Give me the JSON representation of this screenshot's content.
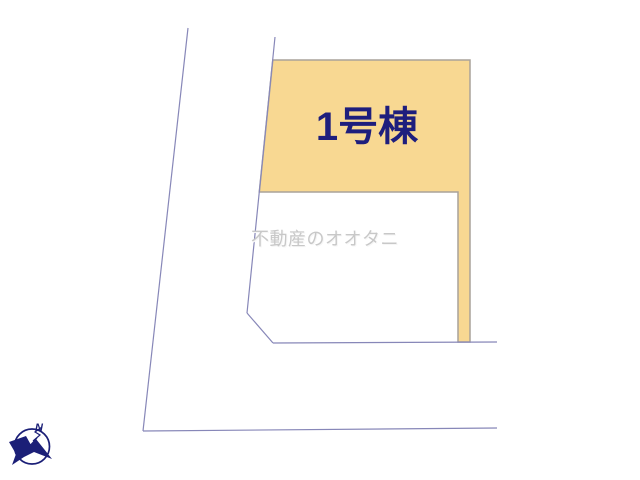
{
  "colors": {
    "background": "#FFFFFF",
    "lot-fill": "#F8D892",
    "lot-border": "#A9A29A",
    "boundary-line": "#8787B8",
    "label-navy": "#1E1E7D",
    "watermark-gray": "#C8C8C8",
    "compass-navy": "#1B1F77"
  },
  "lot": {
    "label": "1号棟"
  },
  "watermark": {
    "text": "不動産のオオタニ"
  },
  "compass": {
    "north_label": "N"
  }
}
